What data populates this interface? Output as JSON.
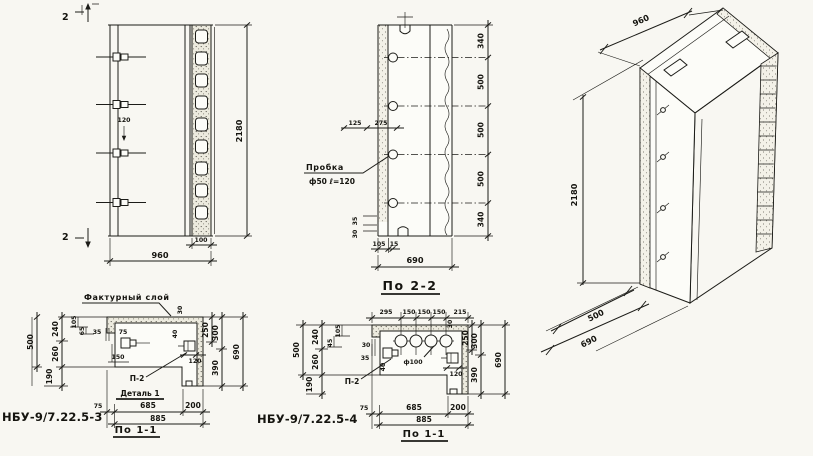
{
  "palette": {
    "paper": "#f8f7f2",
    "ink": "#1c1c18"
  },
  "front_view": {
    "section_mark_top": "2",
    "section_mark_bottom": "2",
    "dim_anchor": "120",
    "dim_height": "2180",
    "dim_width": "960",
    "dim_rib": "100"
  },
  "section_2_2": {
    "title": "По 2-2",
    "plug_label": "Пробка",
    "plug_spec": "ф50 ℓ=120",
    "dims_right": [
      "340",
      "500",
      "500",
      "500",
      "340"
    ],
    "dim_top_left": "125",
    "dim_top_right": "275",
    "dim_step_upper": "35",
    "dim_step_lower": "30",
    "dim_bottom_small": "105",
    "dim_bottom_small2": "15",
    "dim_depth": "690"
  },
  "iso_view": {
    "dim_height": "2180",
    "dim_width": "960",
    "dim_depth_inner": "500",
    "dim_depth": "690"
  },
  "section_3": {
    "part_no": "НБУ-9/7.22.5-3",
    "title": "По 1-1",
    "facade_label": "Фактурный слой",
    "detail_ref": "П-2",
    "detail_label": "Деталь 1",
    "dim_500": "500",
    "dim_240": "240",
    "dim_260": "260",
    "dim_190": "190",
    "dim_105": "105",
    "dim_65": "65",
    "dim_35": "35",
    "dim_75i": "75",
    "dim_150": "150",
    "dim_40": "40",
    "dim_30": "30",
    "dim_120": "120",
    "dim_250": "250",
    "dim_300": "300",
    "dim_390": "390",
    "dim_690": "690",
    "dim_75": "75",
    "dim_685": "685",
    "dim_200": "200",
    "dim_885": "885"
  },
  "section_4": {
    "part_no": "НБУ-9/7.22.5-4",
    "title": "По 1-1",
    "detail_ref": "П-2",
    "hole_label": "ф100",
    "top_dims": [
      "295",
      "150",
      "150",
      "150",
      "215"
    ],
    "dim_30_top": "30",
    "dim_500": "500",
    "dim_240": "240",
    "dim_260": "260",
    "dim_190": "190",
    "dim_105": "105",
    "dim_45": "45",
    "dim_30": "30",
    "dim_35": "35",
    "dim_40": "40",
    "dim_120": "120",
    "dim_250": "250",
    "dim_300": "300",
    "dim_390": "390",
    "dim_690": "690",
    "dim_75": "75",
    "dim_685": "685",
    "dim_200": "200",
    "dim_885": "885"
  }
}
